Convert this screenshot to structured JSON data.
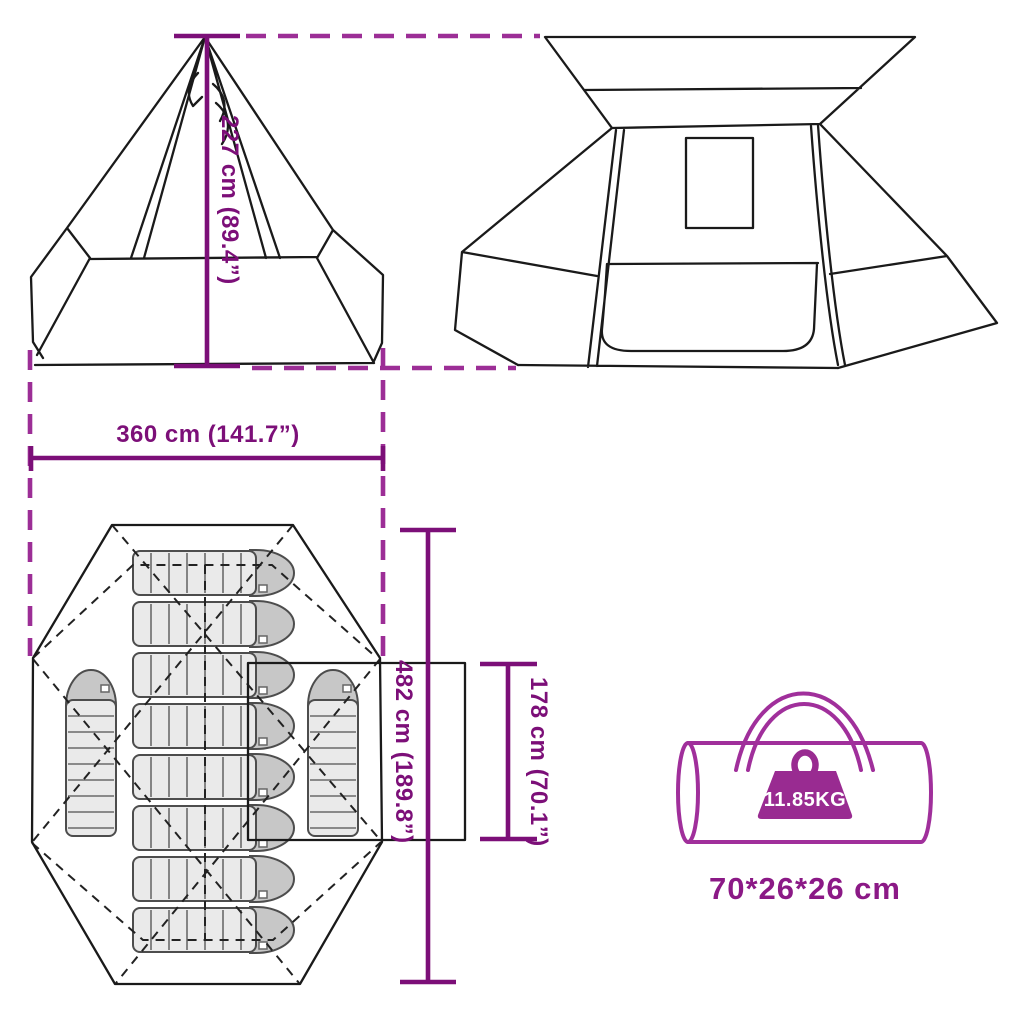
{
  "labels": {
    "height": "227 cm (89.4”)",
    "width": "360 cm (141.7”)",
    "length": "482 cm (189.8”)",
    "door": "178 cm (70.1”)",
    "weight": "11.85KG",
    "packed_size": "70*26*26 cm"
  },
  "icons": {
    "weight": "weight-block-with-handle-icon"
  },
  "colors": {
    "dimension": "#7C0F78",
    "connector": "#9C2E96",
    "bag": "#A02F9B",
    "weight": "#992B91",
    "weight_text": "#ffffff",
    "packed_text": "#8B1986",
    "tent_line": "#1a1a1a",
    "sleeping_bag_fill": "#EAEAEA",
    "sleeping_bag_head": "#C7C7C7"
  }
}
